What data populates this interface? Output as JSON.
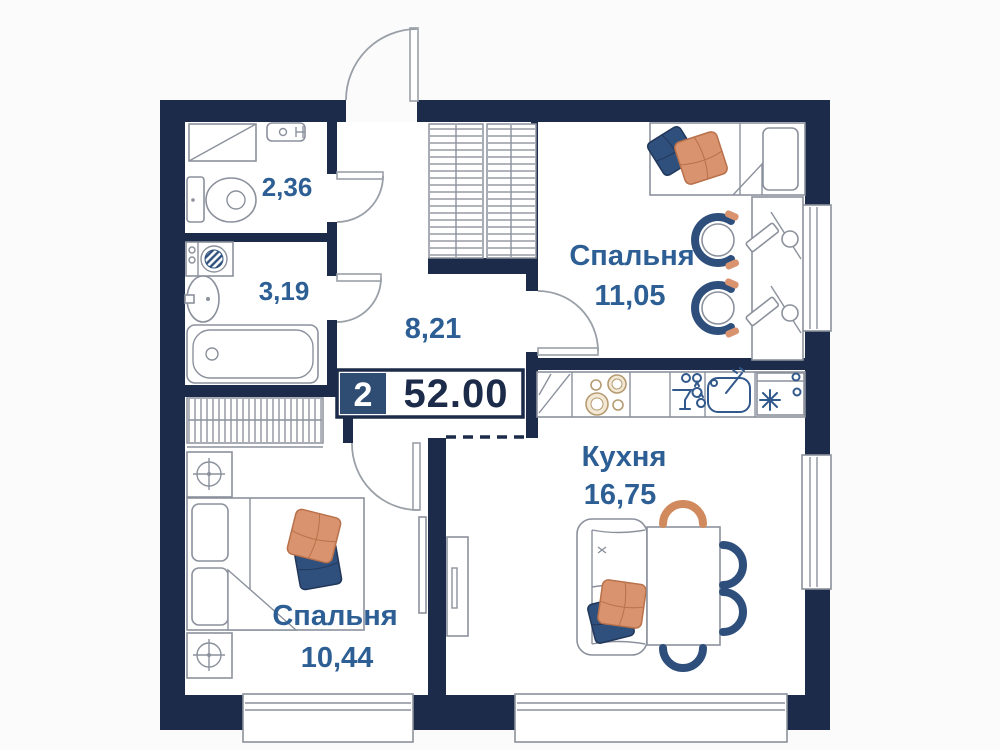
{
  "floorplan": {
    "badge": {
      "rooms_count": "2",
      "total_area": "52.00"
    },
    "rooms": {
      "toilet": {
        "area": "2,36"
      },
      "bathroom": {
        "area": "3,19"
      },
      "hallway": {
        "area": "8,21"
      },
      "bedroom1": {
        "name": "Спальня",
        "area": "11,05"
      },
      "kitchen": {
        "name": "Кухня",
        "area": "16,75"
      },
      "bedroom2": {
        "name": "Спальня",
        "area": "10,44"
      }
    },
    "colors": {
      "wall_navy": "#1c2b49",
      "label_blue": "#2d5f95",
      "badge_square": "#2f4d73",
      "accent_orange": "#d9936f",
      "accent_blue": "#2f507d"
    }
  }
}
